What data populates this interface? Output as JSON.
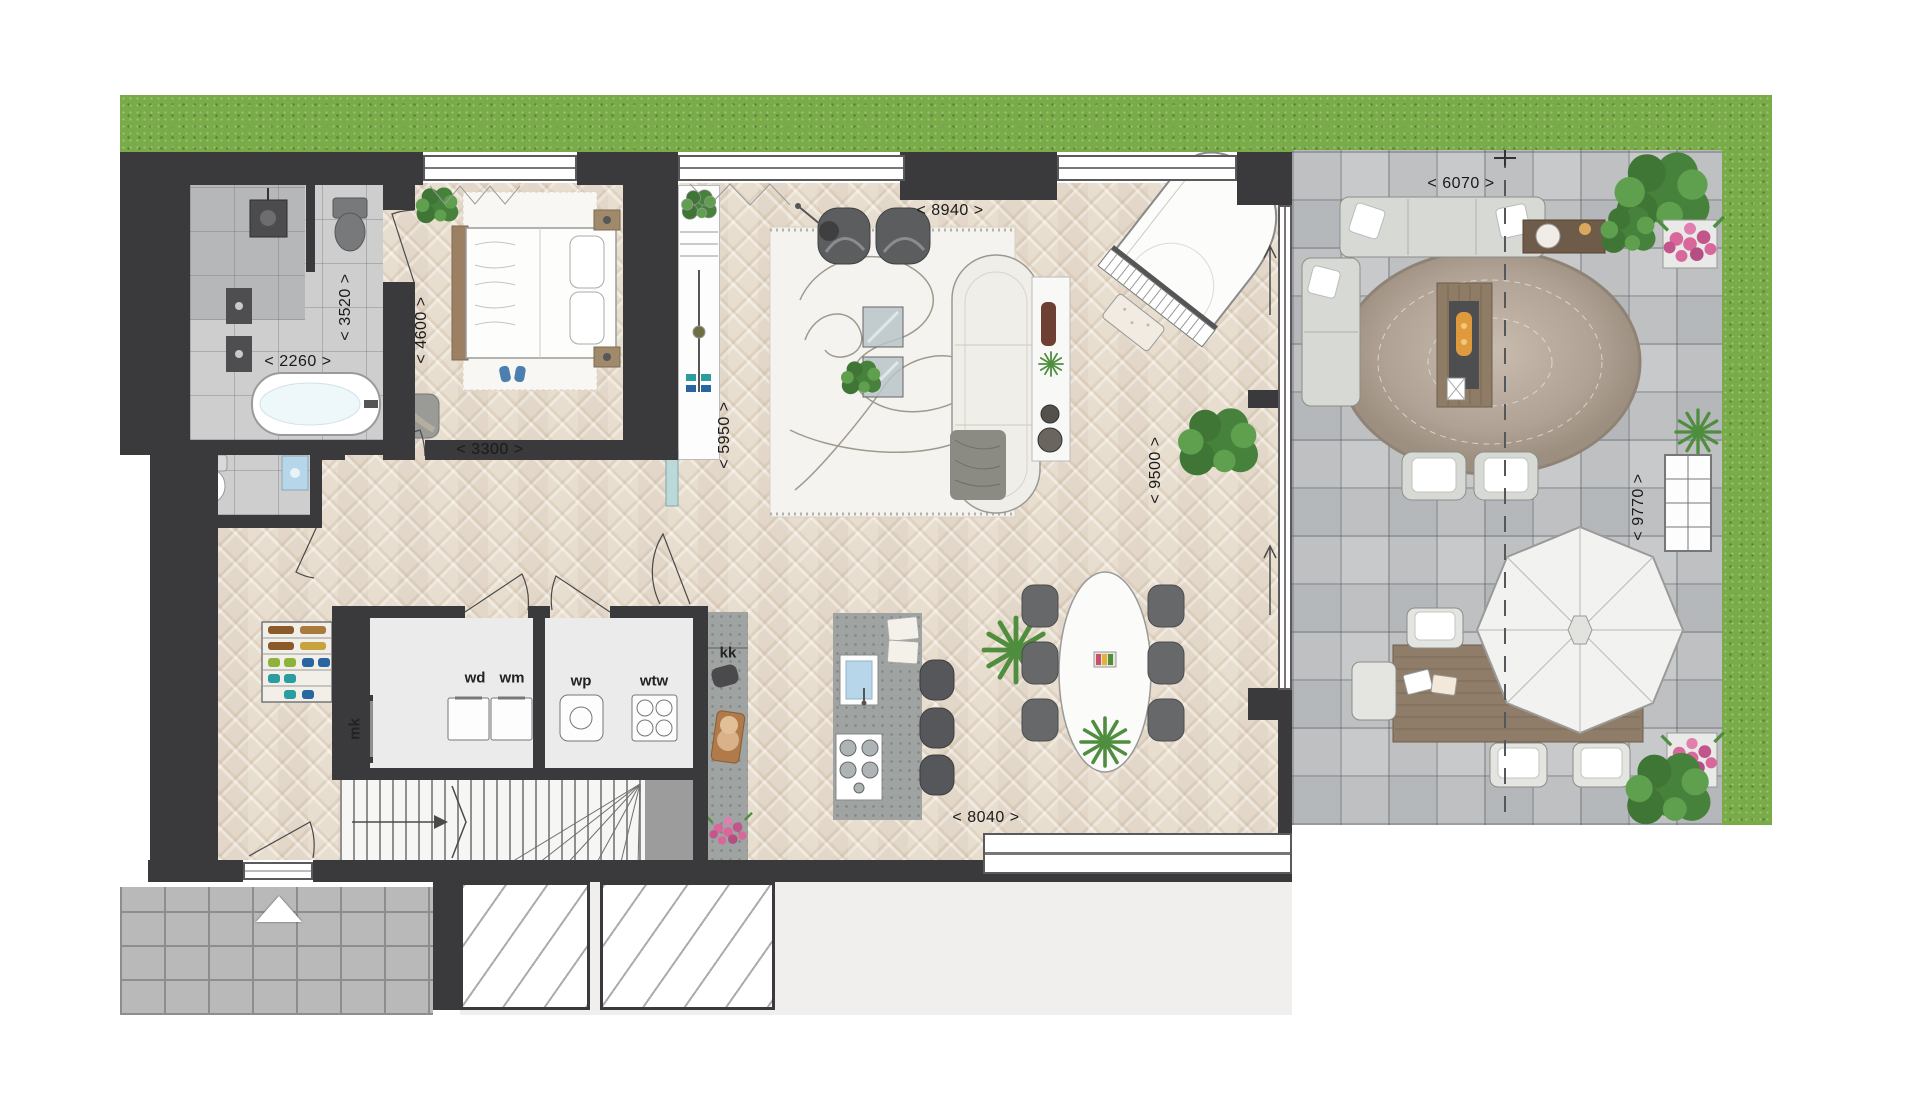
{
  "dims": {
    "bath_width": "< 2260 >",
    "bath_length": "< 3520 >",
    "bedroom_length": "< 4600 >",
    "bedroom_width": "< 3300 >",
    "hall_length": "< 5950 >",
    "living_width": "< 8940 >",
    "living_length": "< 9500 >",
    "terrace_width": "< 6070 >",
    "terrace_length": "< 9770 >",
    "kitchen_width": "< 8040 >"
  },
  "labels": {
    "mk": "mk",
    "wd": "wd",
    "wm": "wm",
    "wp": "wp",
    "wtw": "wtw",
    "kk": "kk"
  },
  "colors": {
    "wall": "#3a3a3c",
    "grass": "#7aab49",
    "floor": "#e8decf",
    "tile": "#cdcecd",
    "paver": "#c7c9ca",
    "concrete": "#9fa3a1",
    "plant_green": "#4f8d3f",
    "flower_pink": "#d8679b",
    "sink_blue": "#b8d6ea"
  }
}
